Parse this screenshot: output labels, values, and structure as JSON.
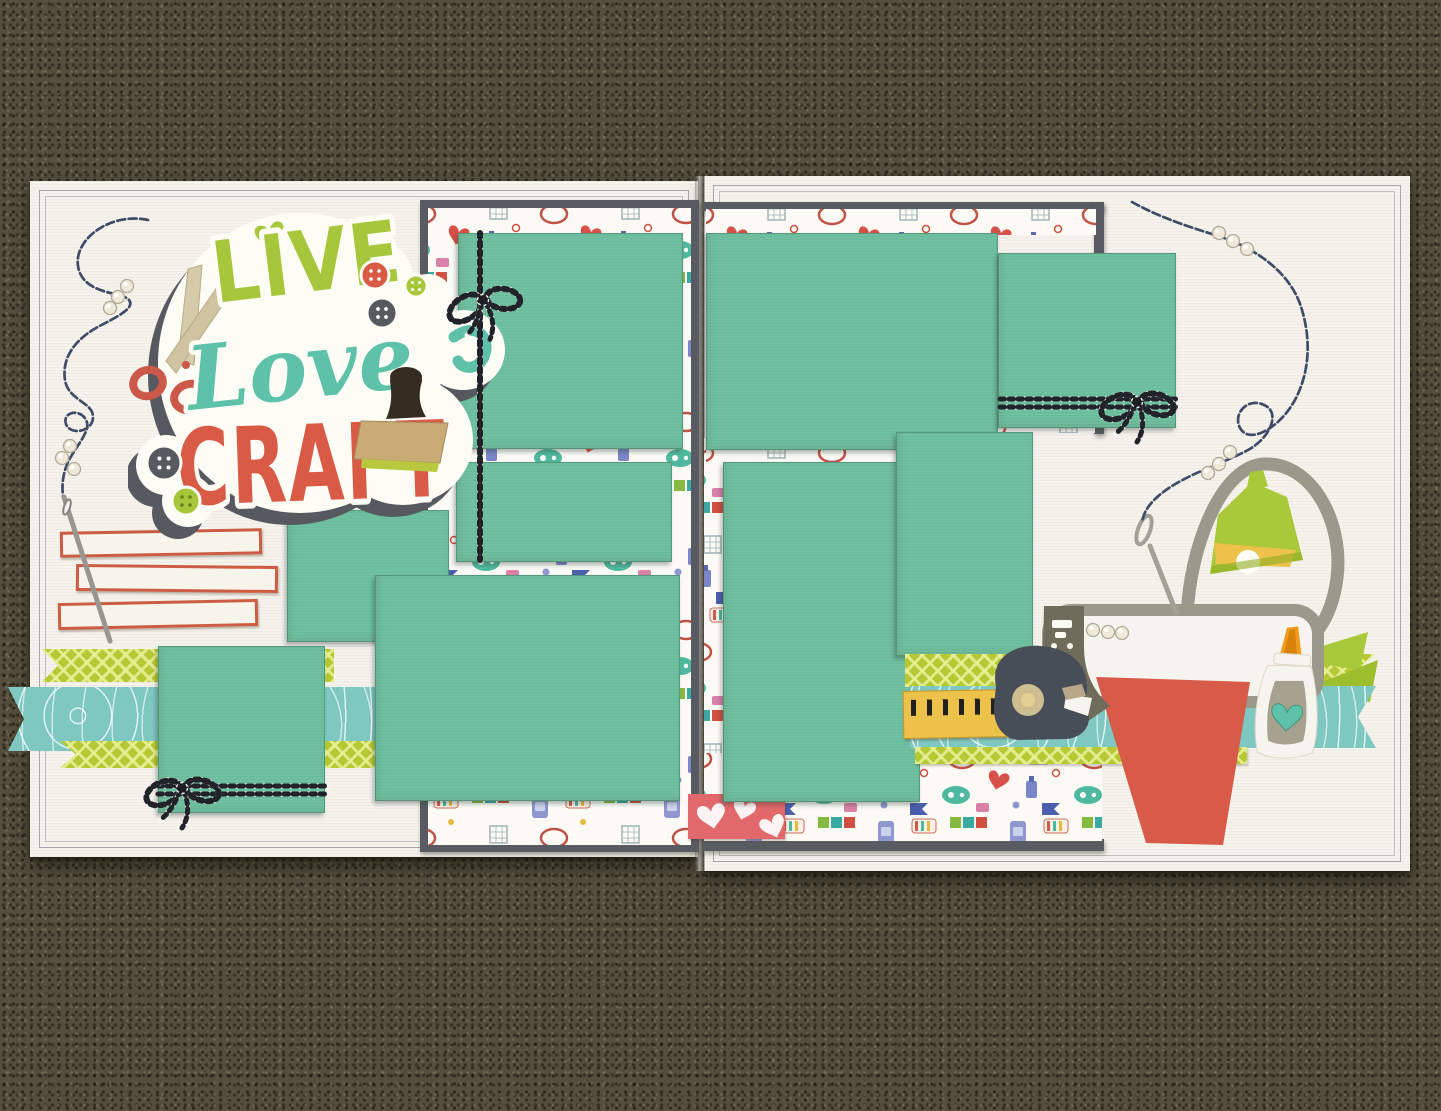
{
  "scene": {
    "type": "photograph",
    "subject": "Two-page 'Live Love Craft' scrapbook layout lying on brown carpet"
  },
  "title_diecut": {
    "word1": "LIVE",
    "word2": "Love",
    "word3": "CRAFT"
  },
  "palette": {
    "carpet_brown": "#544e3e",
    "page_white": "#f5f3ec",
    "teal_cardstock": "#70c1a1",
    "mat_gray": "#585c62",
    "lime_green": "#a6c73b",
    "script_teal": "#5ec1a9",
    "coral_red": "#d95a45",
    "kraft_tan": "#c9ab74",
    "stamp_brown": "#352b21",
    "navy_thread": "#3e4c68",
    "twine_black": "#20242a",
    "washi_lime": "#b6c935",
    "washi_aqua": "#7fc8c2",
    "ruler_yellow": "#ecc24b",
    "machine_gray": "#9b998c",
    "machine_taupe": "#6f6c5c",
    "dispenser_slate": "#474e58",
    "red_cardstock": "#d85a48",
    "glue_orange": "#f09b1d",
    "gem_clear": "#efe9da",
    "pink_scrap": "#e2696b"
  },
  "left_page": {
    "photo_mats": 5,
    "journaling_strips": 3,
    "washi_banners": 3,
    "twine_bows": 2,
    "gem_clusters": 2
  },
  "right_page": {
    "photo_mats": 4,
    "washi_banners": 3,
    "twine_bows": 1,
    "gem_clusters": 3
  },
  "embellishments": [
    "scissors die-cut",
    "rubber stamp die-cut",
    "buttons",
    "lime heart",
    "baker's twine bows",
    "navy stitched thread",
    "sewing needles",
    "rhinestone gems",
    "journaling strips",
    "washi banner strips",
    "yellow ruler",
    "tape dispenser",
    "die-cut machine",
    "desk lamp",
    "glue bottle",
    "red cardstock sheet",
    "pink heart paper scrap",
    "craft-icon patterned paper"
  ]
}
